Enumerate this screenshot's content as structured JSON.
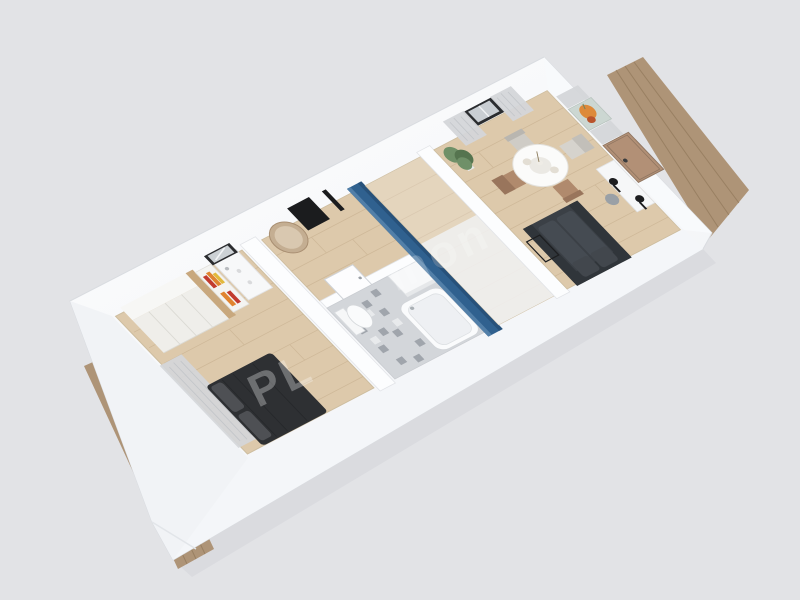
{
  "meta": {
    "type": "3d-floor-plan-render",
    "view": "axonometric-top-down",
    "rooms_count": 5
  },
  "watermark": {
    "fragments": [
      "PL",
      "mon"
    ]
  },
  "colors": {
    "background": "#e2e3e6",
    "shadow": "#b6b9c0",
    "wall_top": "#fdfdfe",
    "wall_bottom": "#f1f3f6",
    "wall_band": "#fcfdfe",
    "wall_face_sw": "#f1f3f6",
    "wall_face_se": "#f4f6f9",
    "wall_face_ne": "#f8fafc",
    "deck_wood": "#ae9477",
    "deck_line": "#8e7458",
    "floor_wood": "#ddc9ab",
    "floor_line": "#c3ab8a",
    "tile_floor": "#d3d6da",
    "tile_accent": "#90959d",
    "accent_blue": "#30618f",
    "accent_blue_light": "#527fa8",
    "accent_blue_dark": "#27517a",
    "sofa": "#3b4046",
    "sofa_dark": "#30353a",
    "sofa_light": "#454b52",
    "bed": "#2e3033",
    "bed_light": "#4e5054",
    "wardrobe": "#efeeea",
    "wood_panel": "#c8a87e",
    "shelf_red": "#c23b2e",
    "shelf_orange": "#e08430",
    "shelf_yellow": "#e2b93c",
    "white_furniture": "#f7f8f9",
    "door_dark": "#1b1c1e",
    "door_wood": "#b29076",
    "door_wood_frame": "#8f7560",
    "curtain": "#d4d6d9",
    "window_frame": "#2a2c2f",
    "window_glass": "#c9ced3",
    "mirror_frame": "#2b2c2f",
    "mirror_glass": "#ccd1d5",
    "oval_mirror": "#c4ae92",
    "plant_green": "#6f9068",
    "plant_green_dark": "#55744f",
    "lamp_black": "#1d1e20",
    "stool_gray": "#9aa0a6",
    "art_bg": "#ccd7d2",
    "art_orange": "#dd8a3a",
    "art_red": "#b9542c",
    "watermark": "#ffffff"
  },
  "rooms": [
    {
      "label": "bedroom",
      "floor": "wood",
      "furniture": [
        "wardrobe",
        "wood-side-panel",
        "bookshelf",
        "vanity",
        "vanity-mirror",
        "double-bed",
        "window-curtain"
      ]
    },
    {
      "label": "hallway",
      "floor": "wood",
      "furniture": [
        "entrance-door",
        "oval-mirror"
      ]
    },
    {
      "label": "bathroom",
      "floor": "patterned-tile",
      "furniture": [
        "toilet",
        "bathtub",
        "cabinet",
        "bathroom-door"
      ]
    },
    {
      "label": "middle-room",
      "floor": "wood",
      "furniture": [
        "blue-accent-wall"
      ]
    },
    {
      "label": "living-room",
      "floor": "wood",
      "furniture": [
        "dining-table",
        "dining-chairs",
        "sofa",
        "coffee-table",
        "desk",
        "floor-lamps",
        "stool",
        "potted-plant",
        "window",
        "curtains",
        "wall-art",
        "entry-door"
      ]
    }
  ],
  "exterior": {
    "terraces": [
      "deck-left",
      "deck-right"
    ]
  }
}
